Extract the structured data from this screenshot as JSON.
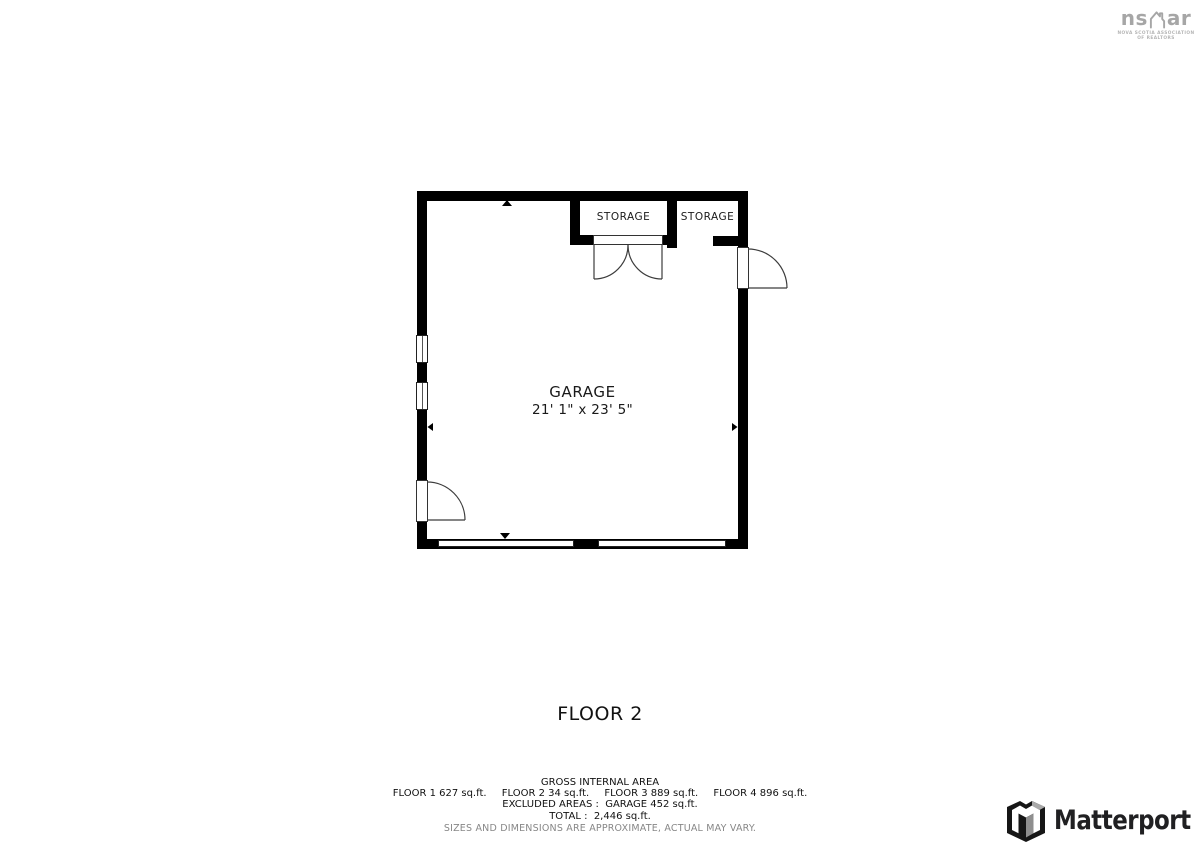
{
  "header": {
    "nsar_logo": {
      "wordmark_left": "ns",
      "wordmark_right": "ar",
      "caption_line1": "NOVA SCOTIA ASSOCIATION",
      "caption_line2": "OF REALTORS",
      "color": "#a6a6a6"
    }
  },
  "floor_plan": {
    "wall_color": "#000000",
    "rooms": {
      "garage": {
        "name": "GARAGE",
        "dimensions": "21' 1\" x 23' 5\""
      },
      "storage_left": {
        "name": "STORAGE"
      },
      "storage_right": {
        "name": "STORAGE"
      }
    }
  },
  "floor_label": "FLOOR 2",
  "area_summary": {
    "title": "GROSS INTERNAL AREA",
    "floor_areas": [
      "FLOOR 1 627 sq.ft.",
      "FLOOR 2 34 sq.ft.",
      "FLOOR 3 889 sq.ft.",
      "FLOOR 4 896 sq.ft."
    ],
    "excluded_line": "EXCLUDED AREAS :  GARAGE 452 sq.ft.",
    "total_line": "TOTAL :  2,446 sq.ft.",
    "disclaimer": "SIZES AND DIMENSIONS ARE APPROXIMATE, ACTUAL MAY VARY."
  },
  "footer": {
    "matterport_logo_text": "Matterport"
  }
}
